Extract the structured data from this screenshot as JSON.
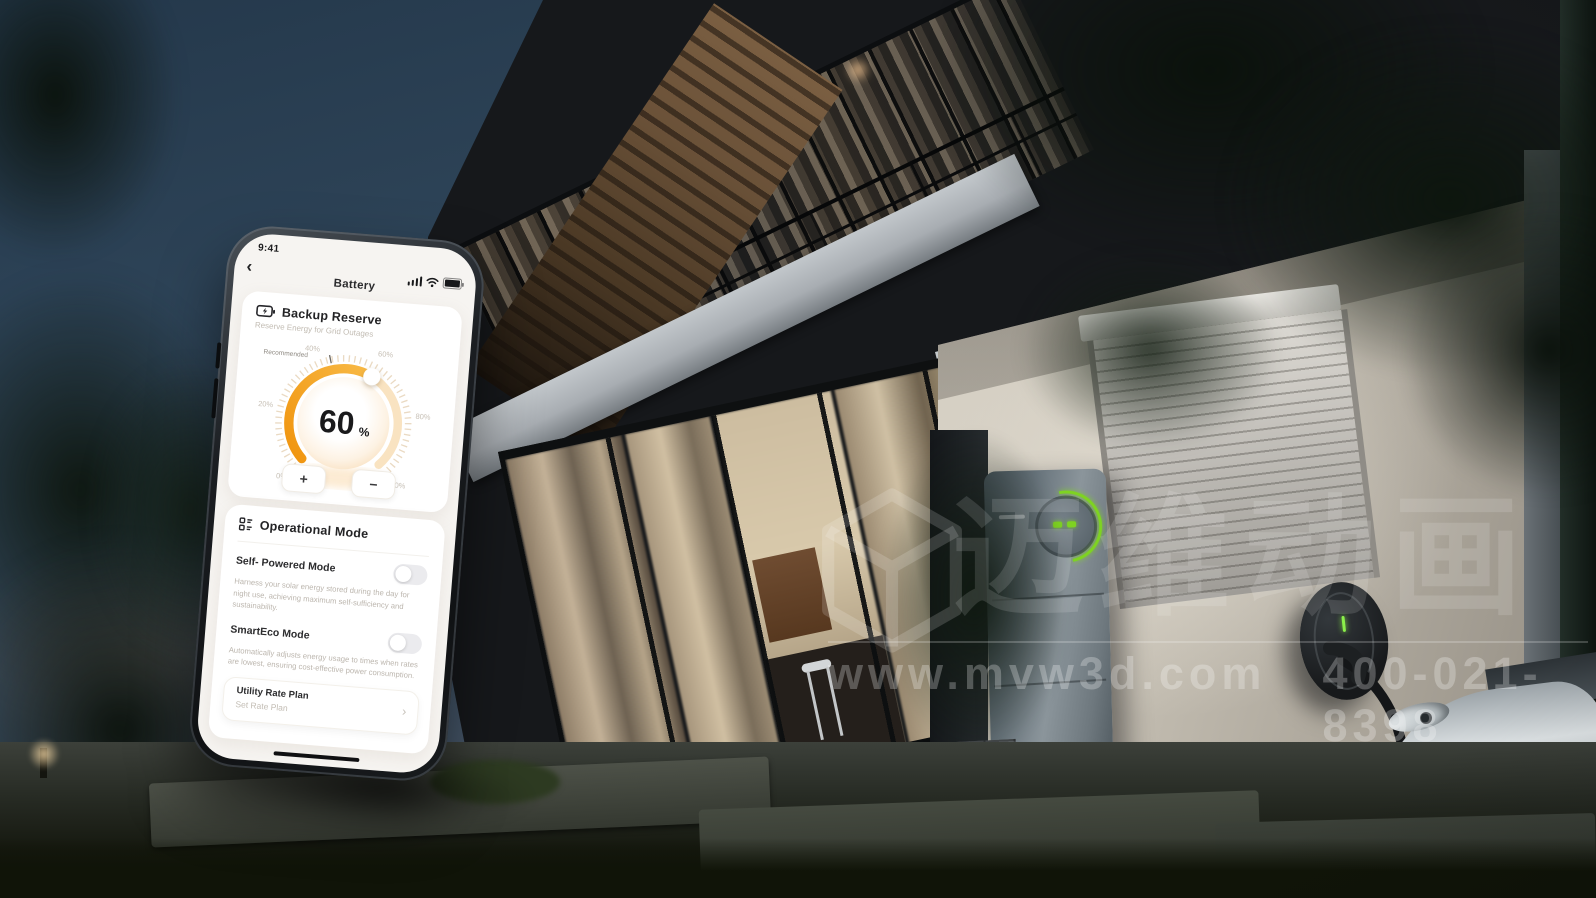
{
  "scene": {
    "watermark": {
      "brand": "迈维动画",
      "url": "www.mvw3d.com",
      "phone": "400-021-8398"
    }
  },
  "phone_ui": {
    "status_bar": {
      "time": "9:41",
      "signal_icon": "signal-bars",
      "wifi_icon": "wifi-arcs",
      "battery_icon": "battery-full"
    },
    "nav": {
      "back_icon": "‹",
      "title": "Battery"
    },
    "backup_reserve": {
      "icon": "battery-bolt",
      "title": "Backup Reserve",
      "subtitle": "Reserve Energy for Grid Outages",
      "recommended_label": "Recommended",
      "value": "60",
      "unit": "%",
      "tick_labels": [
        "0%",
        "20%",
        "40%",
        "60%",
        "80%",
        "100%"
      ],
      "increase_label": "+",
      "decrease_label": "−",
      "arc_color": "#F5A41F",
      "arc_track_color": "#F7DCB2"
    },
    "operational_mode": {
      "icon": "list-grid",
      "title": "Operational Mode",
      "items": [
        {
          "label": "Self- Powered Mode",
          "enabled": false,
          "description": "Harness your solar energy stored during the day for night use, achieving maximum self-sufficiency and sustainability."
        },
        {
          "label": "SmartEco Mode",
          "enabled": false,
          "description": "Automatically adjusts energy usage to times when rates are lowest, ensuring cost-effective power consumption."
        }
      ],
      "utility_rate_plan": {
        "title": "Utility Rate Plan",
        "subtitle": "Set Rate Plan",
        "chevron_icon": "›"
      }
    }
  }
}
